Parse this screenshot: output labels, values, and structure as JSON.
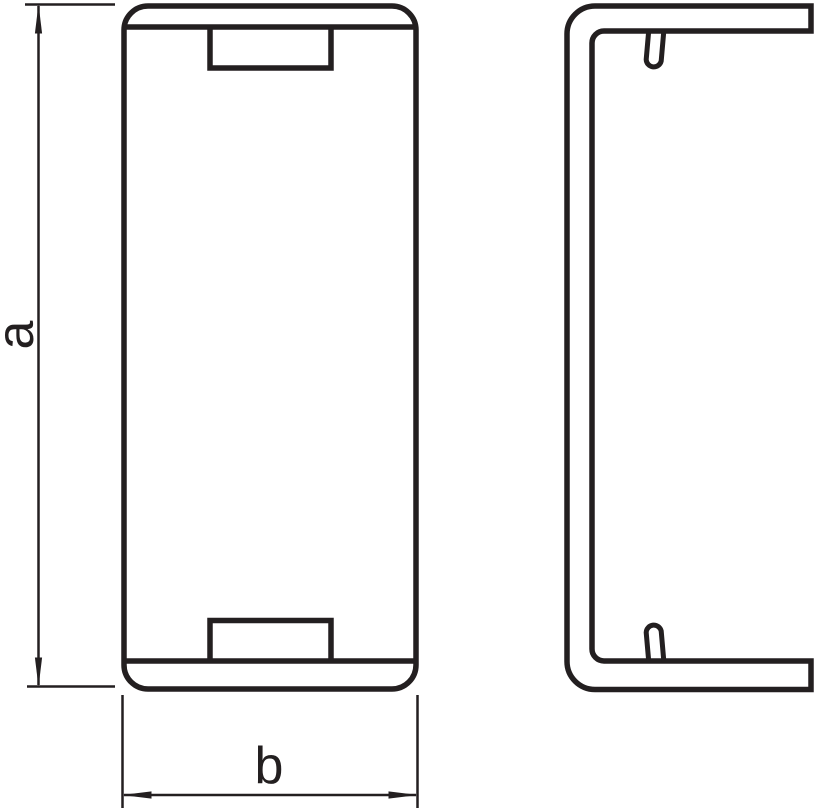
{
  "drawing_type": "technical-drawing",
  "views": [
    {
      "name": "front-view"
    },
    {
      "name": "side-view"
    }
  ],
  "dimensions": {
    "height": {
      "label": "a"
    },
    "width": {
      "label": "b"
    }
  },
  "colors": {
    "line": "#231f20",
    "background": "#ffffff"
  }
}
